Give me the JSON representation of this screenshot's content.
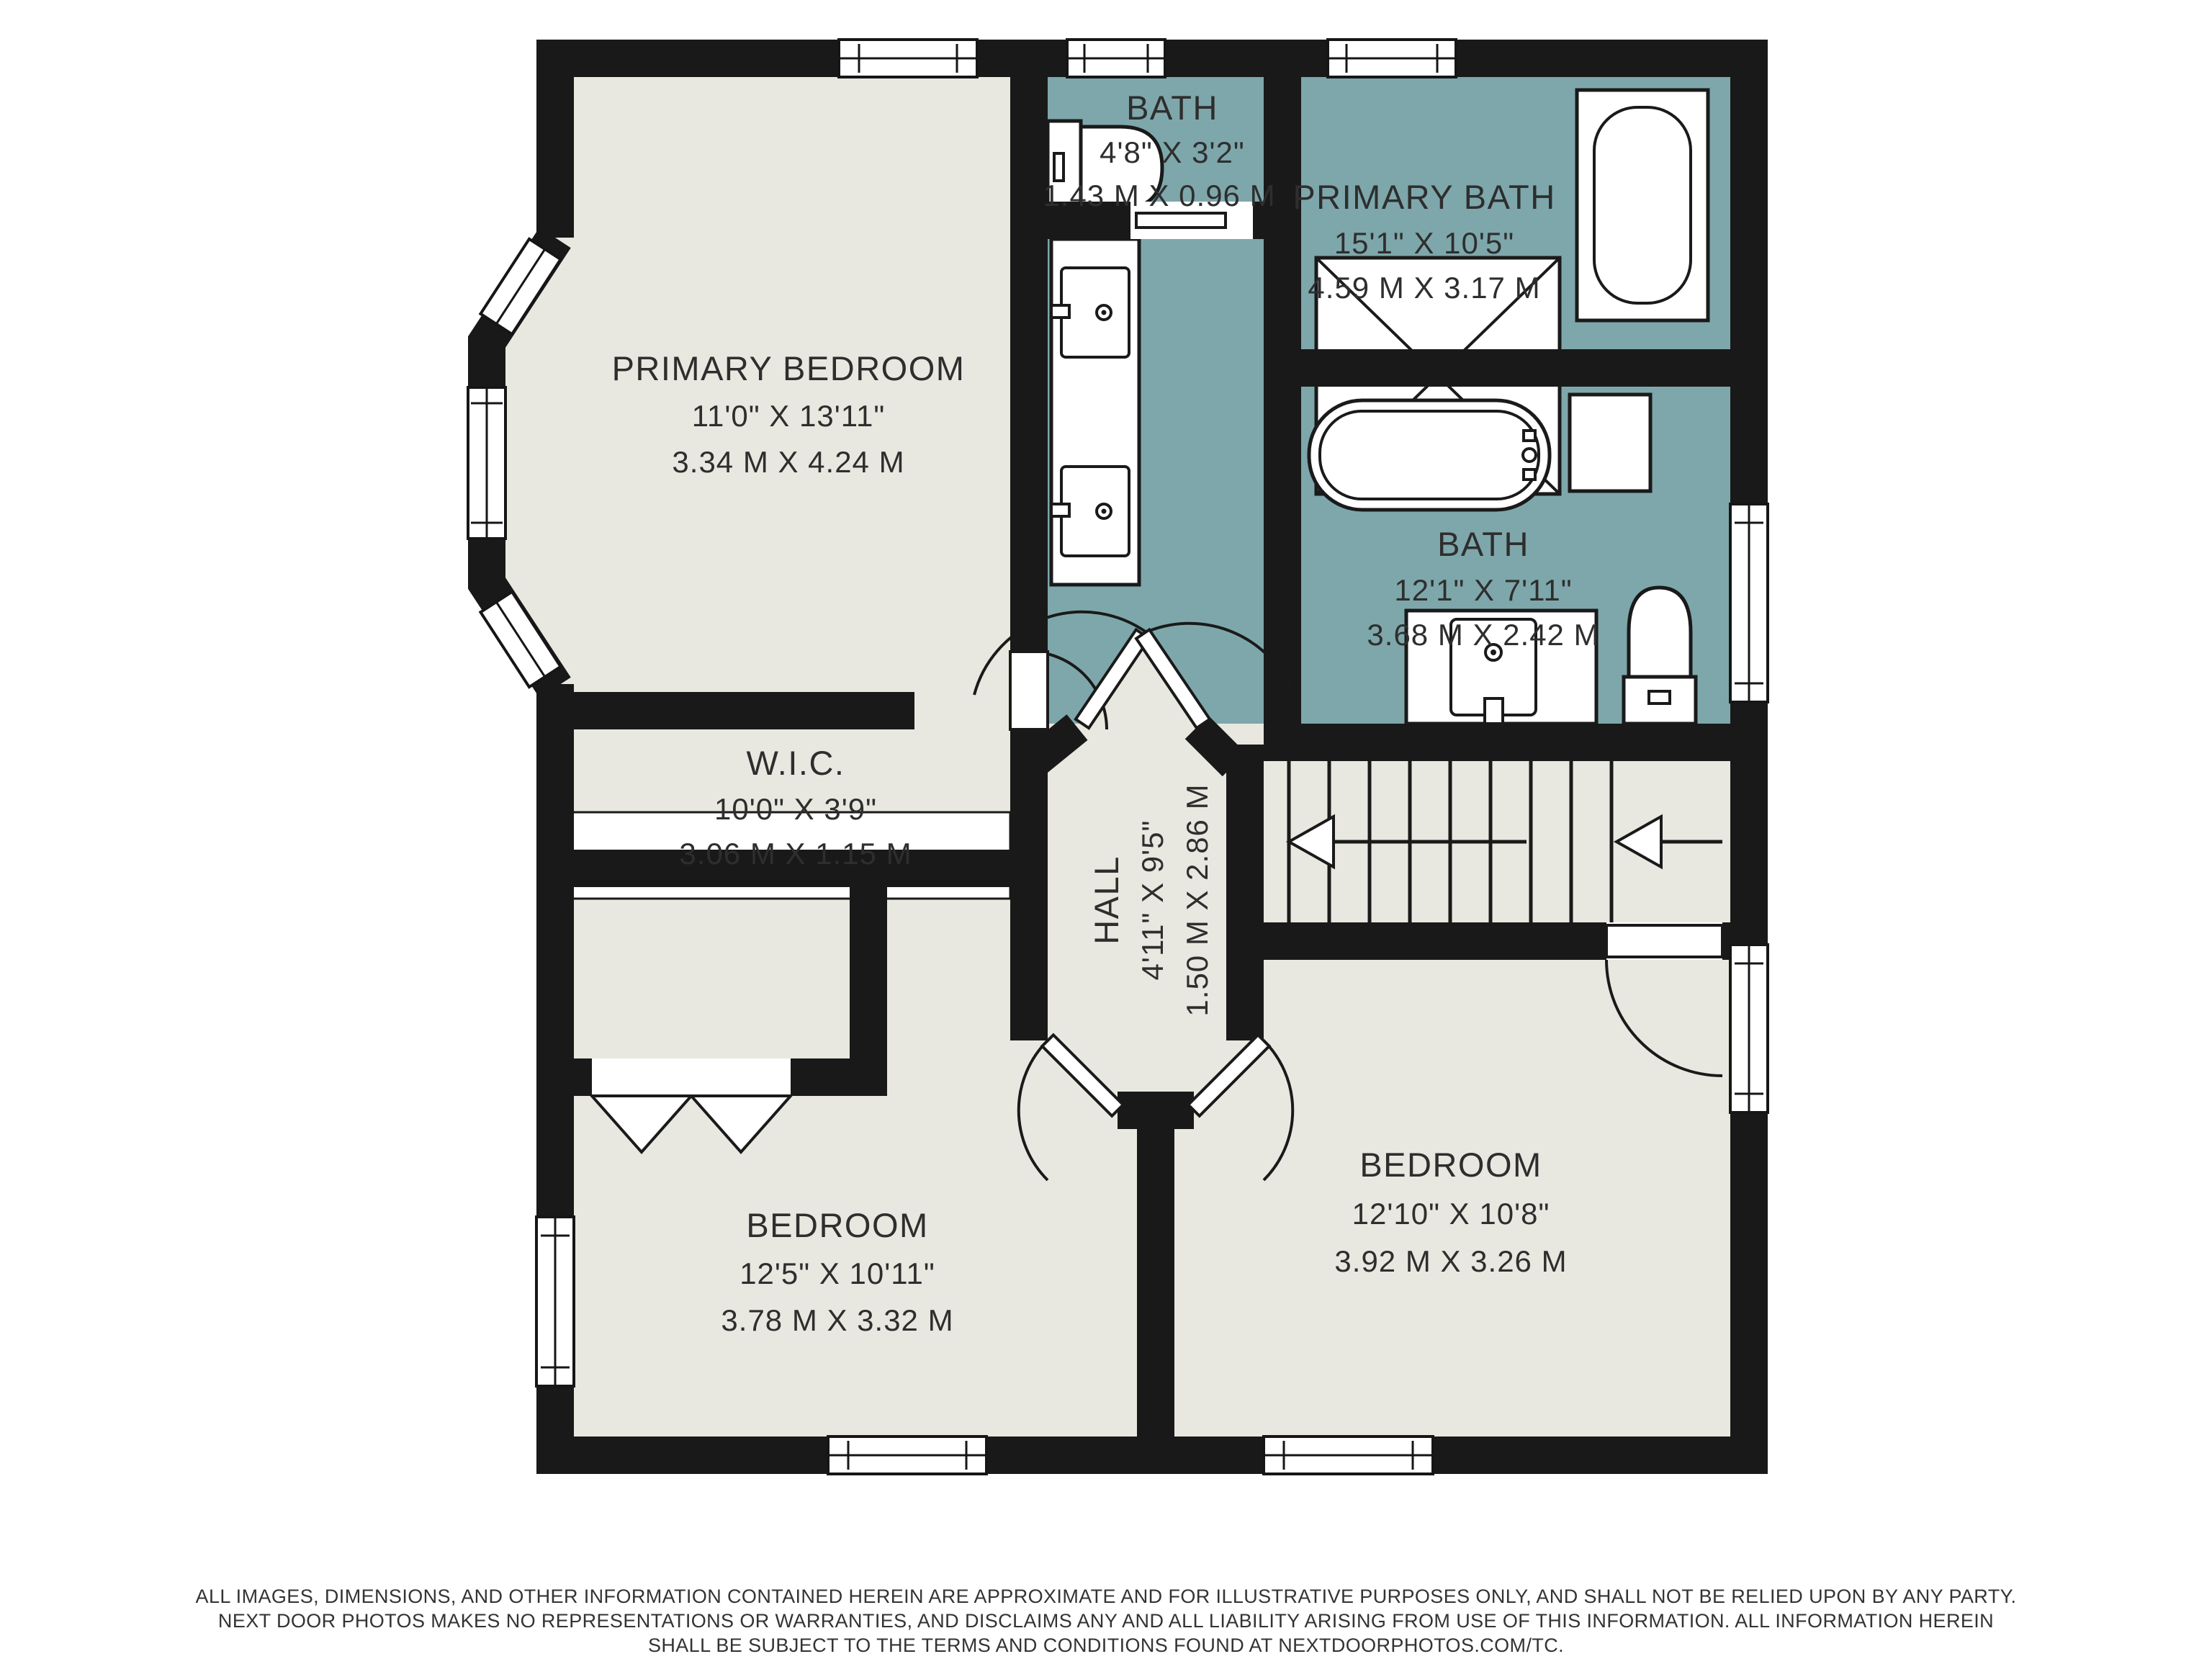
{
  "colors": {
    "floor_beige": "#e9e8e0",
    "floor_teal": "#7ea7ab",
    "wall_black": "#191919",
    "page_white": "#ffffff",
    "text_dark": "#2e2e2e"
  },
  "rooms": [
    {
      "id": "primary-bedroom",
      "name": "PRIMARY BEDROOM",
      "imperial": "11'0\" X 13'11\"",
      "metric": "3.34 M X 4.24 M"
    },
    {
      "id": "bath-small",
      "name": "BATH",
      "imperial": "4'8\" X 3'2\"",
      "metric": "1.43 M X 0.96 M"
    },
    {
      "id": "primary-bath",
      "name": "PRIMARY BATH",
      "imperial": "15'1\" X 10'5\"",
      "metric": "4.59 M X 3.17 M"
    },
    {
      "id": "bath",
      "name": "BATH",
      "imperial": "12'1\" X 7'11\"",
      "metric": "3.68 M X 2.42 M"
    },
    {
      "id": "wic",
      "name": "W.I.C.",
      "imperial": "10'0\" X 3'9\"",
      "metric": "3.06 M X 1.15 M"
    },
    {
      "id": "hall",
      "name": "HALL",
      "imperial": "4'11\" X 9'5\"",
      "metric": "1.50 M X 2.86 M"
    },
    {
      "id": "bedroom-left",
      "name": "BEDROOM",
      "imperial": "12'5\" X 10'11\"",
      "metric": "3.78 M X 3.32 M"
    },
    {
      "id": "bedroom-right",
      "name": "BEDROOM",
      "imperial": "12'10\" X 10'8\"",
      "metric": "3.92 M X 3.26 M"
    }
  ],
  "fixtures": [
    "toilet",
    "double-sink-vanity",
    "walk-in-shower",
    "soaking-tub",
    "freestanding-tub",
    "linen-shelf",
    "single-sink-vanity",
    "toilet",
    "staircase",
    "closet-rod",
    "bifold-closet-doors",
    "pocket-door",
    "swing-doors",
    "windows"
  ],
  "disclaimer": {
    "line1": "ALL IMAGES, DIMENSIONS, AND OTHER INFORMATION CONTAINED HEREIN ARE APPROXIMATE AND FOR ILLUSTRATIVE PURPOSES ONLY, AND SHALL NOT BE RELIED UPON BY ANY PARTY.",
    "line2": "NEXT DOOR PHOTOS MAKES NO REPRESENTATIONS OR WARRANTIES, AND DISCLAIMS ANY AND ALL LIABILITY ARISING FROM USE OF THIS INFORMATION. ALL INFORMATION HEREIN",
    "line3": "SHALL BE SUBJECT TO THE TERMS AND CONDITIONS FOUND AT NEXTDOORPHOTOS.COM/TC."
  }
}
